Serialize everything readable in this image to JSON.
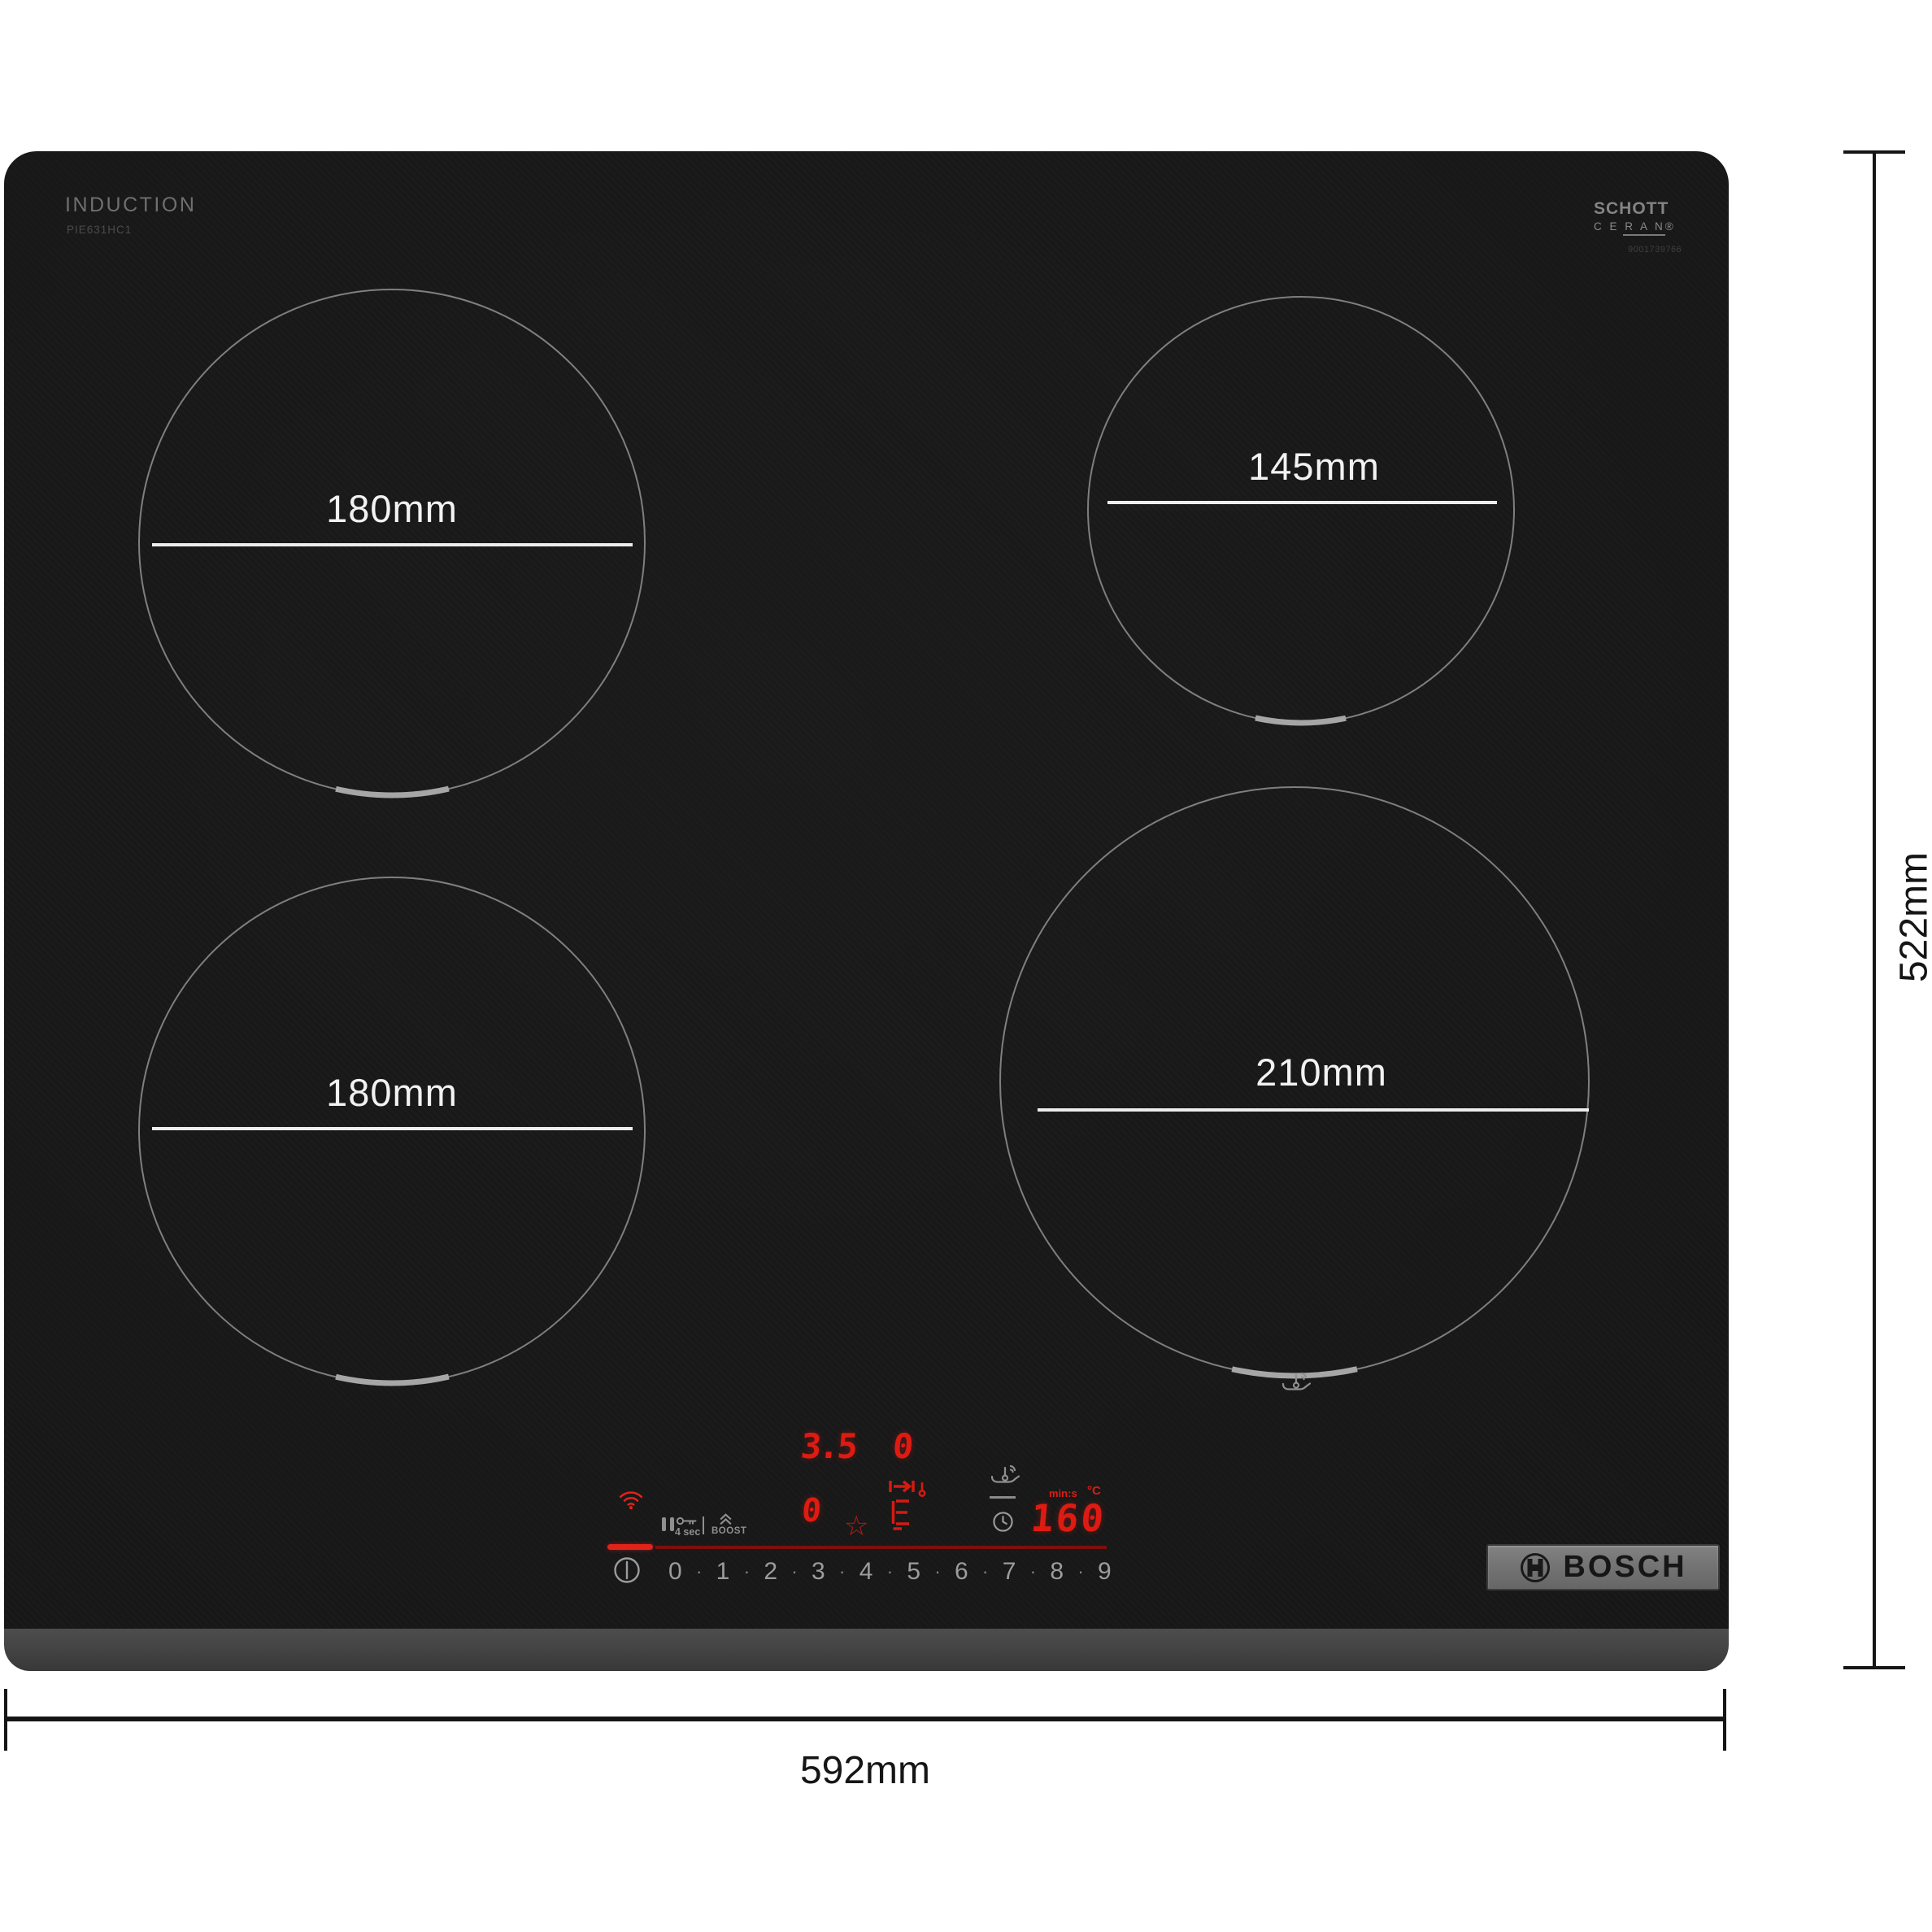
{
  "product": {
    "type_label": "INDUCTION",
    "model_number": "PIE631HC1",
    "glass_brand": {
      "line1": "SCHOTT",
      "line2": "C E R A N®",
      "serial": "9001739766"
    },
    "brand_logo": "BOSCH"
  },
  "annotations": {
    "overall_width": "592mm",
    "overall_height": "522mm"
  },
  "burners": [
    {
      "position": "rear-left",
      "diameter": "180mm"
    },
    {
      "position": "rear-right",
      "diameter": "145mm"
    },
    {
      "position": "front-left",
      "diameter": "180mm"
    },
    {
      "position": "front-right",
      "diameter": "210mm"
    }
  ],
  "control_panel": {
    "zone_display_top_left": "3.5",
    "zone_display_top_right": "0",
    "zone_display_bottom": "0",
    "timer_unit_label": "min:s",
    "temp_unit_label": "°C",
    "temp_display": "160",
    "key_hold_label": "4 sec",
    "boost_label": "BOOST",
    "power_levels": [
      "0",
      "1",
      "2",
      "3",
      "4",
      "5",
      "6",
      "7",
      "8",
      "9"
    ],
    "level_separator": "·",
    "star_glyph": "☆"
  },
  "colors": {
    "accent-red": "#e2231a",
    "display-red": "#de1b12",
    "dim-red": "#7c100c",
    "icon-gray": "#8f8f8f",
    "ring-gray": "#7f7f7f",
    "label-white": "#f2f2f2"
  }
}
